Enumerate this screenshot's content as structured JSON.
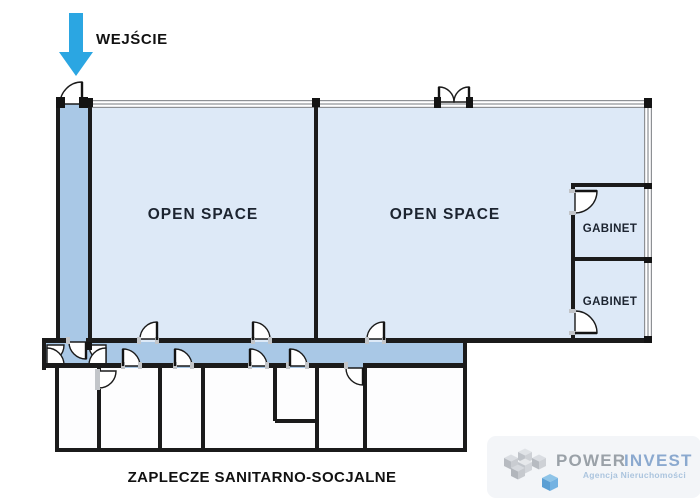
{
  "plan": {
    "entrance": {
      "label": "WEJŚCIE",
      "arrow_color": "#2ba6e2"
    },
    "labels": {
      "open_space_1": "OPEN SPACE",
      "open_space_2": "OPEN SPACE",
      "gabinet_top": "GABINET",
      "gabinet_bottom": "GABINET",
      "zaplecze": "ZAPLECZE SANITARNO-SOCJALNE"
    },
    "colors": {
      "room_fill": "#dde9f7",
      "corridor_fill": "#a9c8e6",
      "bottom_rooms_fill": "#fdfdfe",
      "wall": "#1b1b1b",
      "window_wall_line": "#8d9094",
      "label_text": "#1c2430"
    }
  },
  "logo": {
    "brand_primary": "POWER",
    "brand_secondary": "INVEST",
    "tagline": "Agencja Nieruchomości",
    "colors": {
      "primary_text": "#9aa1a8",
      "secondary_text": "#8ba9cf",
      "tagline_text": "#abc4de",
      "cube_blue": "#5b9fd4",
      "panel_bg": "#f3f5f8"
    }
  }
}
